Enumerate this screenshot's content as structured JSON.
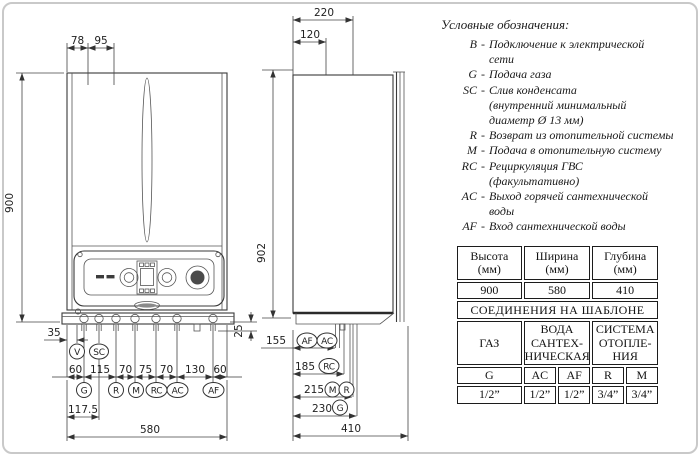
{
  "front_view": {
    "dim_top_left": "78",
    "dim_top_right": "95",
    "dim_height": "900",
    "dim_left_offset": "35",
    "dim_right_offset": "25",
    "dim_chain": [
      "60",
      "115",
      "70",
      "75",
      "70",
      "130",
      "60"
    ],
    "dim_sc_offset": "117.5",
    "dim_width": "580",
    "ports_top": [
      {
        "label": "V"
      },
      {
        "label": "SC"
      }
    ],
    "ports_bottom": [
      {
        "label": "G"
      },
      {
        "label": "R"
      },
      {
        "label": "M"
      },
      {
        "label": "RC"
      },
      {
        "label": "AC"
      },
      {
        "label": "AF"
      }
    ]
  },
  "side_view": {
    "dim_top_outer": "220",
    "dim_top_inner": "120",
    "dim_height": "902",
    "dim_depth": "410",
    "rows": [
      {
        "dim": "155",
        "ports": [
          "AF",
          "AC"
        ]
      },
      {
        "dim": "185",
        "ports": [
          "RC"
        ]
      },
      {
        "dim": "215",
        "ports": [
          "M",
          "R"
        ]
      },
      {
        "dim": "230",
        "ports": [
          "G"
        ]
      }
    ]
  },
  "legend": {
    "title": "Условные обозначения:",
    "dash": "-",
    "items": [
      {
        "key": "B",
        "text": "Подключение к электрической\nсети"
      },
      {
        "key": "G",
        "text": "Подача газа"
      },
      {
        "key": "SC",
        "text": "Слив конденсата\n(внутренний минимальный\nдиаметр Ø 13 мм)"
      },
      {
        "key": "R",
        "text": "Возврат из отопительной системы"
      },
      {
        "key": "M",
        "text": "Подача в отопительную систему"
      },
      {
        "key": "RC",
        "text": "Рециркуляция ГВС\n(факультативно)"
      },
      {
        "key": "AC",
        "text": "Выход горячей сантехнической\nводы"
      },
      {
        "key": "AF",
        "text": "Вход сантехнической воды"
      }
    ]
  },
  "spec_table": {
    "dim_headers": [
      "Высота\n(мм)",
      "Ширина\n(мм)",
      "Глубина\n(мм)"
    ],
    "dim_values": [
      "900",
      "580",
      "410"
    ],
    "section_title": "СОЕДИНЕНИЯ НА ШАБЛОНЕ",
    "group_headers": [
      "ГАЗ",
      "ВОДА\nСАНТЕХ-\nНИЧЕСКАЯ",
      "СИСТЕМА\nОТОПЛЕ-\nНИЯ"
    ],
    "conn_labels": [
      "G",
      "AC",
      "AF",
      "R",
      "M"
    ],
    "conn_values": [
      "1/2”",
      "1/2”",
      "1/2”",
      "3/4”",
      "3/4”"
    ]
  },
  "colors": {
    "line": "#3a3a3a",
    "text": "#1a1a1a",
    "frame": "#c9c9c9"
  }
}
